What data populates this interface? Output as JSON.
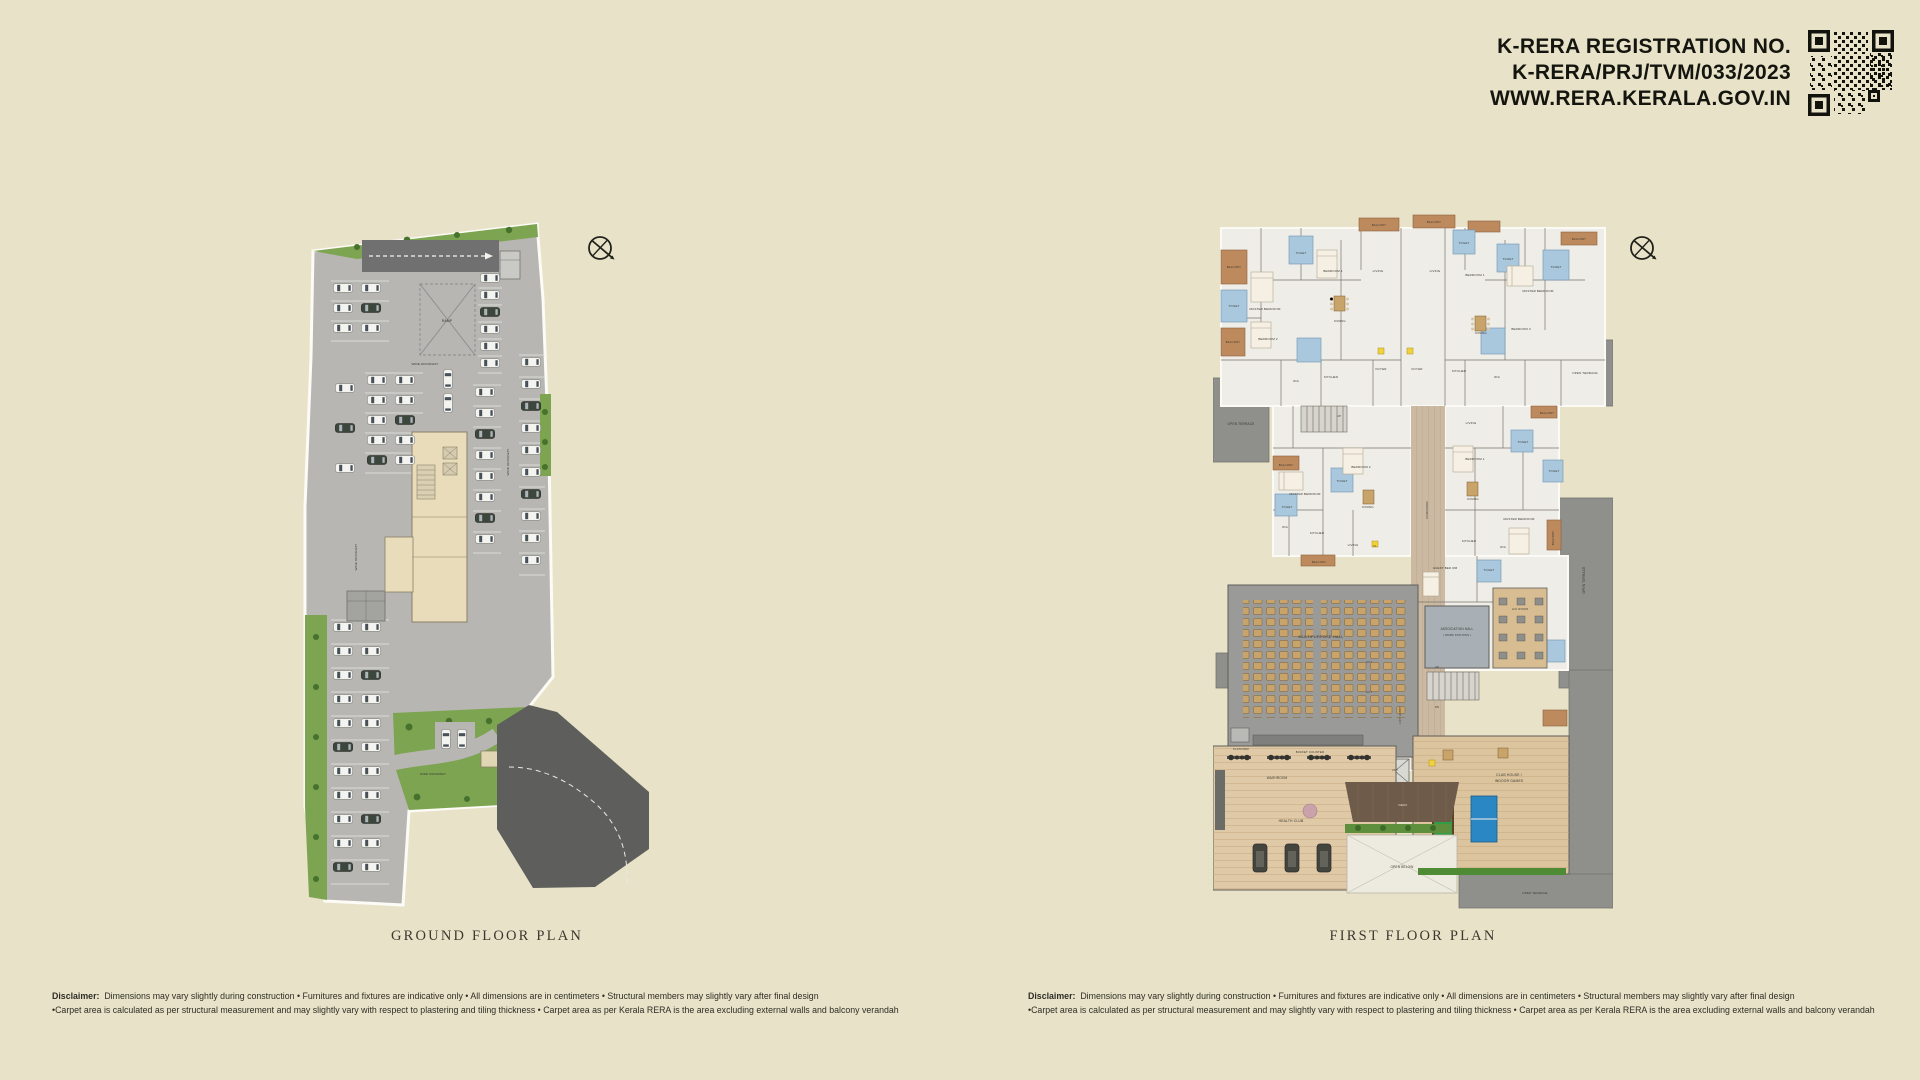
{
  "header": {
    "line1": "K-RERA REGISTRATION NO.",
    "line2": "K-RERA/PRJ/TVM/033/2023",
    "line3": "WWW.RERA.KERALA.GOV.IN"
  },
  "plans": {
    "ground": {
      "title": "GROUND FLOOR PLAN",
      "labels": [
        {
          "t": "RAMP",
          "x": 150,
          "y": 115,
          "s": 3.4
        },
        {
          "t": "WIDE DRIVEWAY",
          "x": 128,
          "y": 158,
          "s": 3.1
        },
        {
          "t": "WIDE DRIVEWAY",
          "x": 60,
          "y": 350,
          "r": -90,
          "s": 3.1
        },
        {
          "t": "WIDE DRIVEWAY",
          "x": 212,
          "y": 255,
          "r": -90,
          "s": 3.1
        },
        {
          "t": "WIDE DRIVEWAY",
          "x": 136,
          "y": 568,
          "s": 3
        }
      ]
    },
    "first": {
      "title": "FIRST FLOOR PLAN",
      "labels": [
        {
          "t": "BALCONY",
          "x": 21,
          "y": 58,
          "s": 2.8
        },
        {
          "t": "TOILET",
          "x": 21,
          "y": 97,
          "s": 2.8
        },
        {
          "t": "BALCONY",
          "x": 20,
          "y": 133,
          "s": 2.8
        },
        {
          "t": "MASTER BEDROOM",
          "x": 52,
          "y": 100,
          "s": 3
        },
        {
          "t": "BEDROOM 2",
          "x": 55,
          "y": 130,
          "s": 3
        },
        {
          "t": "TOILET",
          "x": 88,
          "y": 44,
          "s": 2.8
        },
        {
          "t": "BEDROOM 1",
          "x": 120,
          "y": 62,
          "s": 3
        },
        {
          "t": "DINING",
          "x": 127,
          "y": 112,
          "s": 3
        },
        {
          "t": "BALCONY",
          "x": 166,
          "y": 16,
          "s": 2.8
        },
        {
          "t": "LIVING",
          "x": 165,
          "y": 62,
          "s": 3
        },
        {
          "t": "BALCONY",
          "x": 221,
          "y": 13,
          "s": 2.8
        },
        {
          "t": "LIVING",
          "x": 222,
          "y": 62,
          "s": 3
        },
        {
          "t": "TOILET",
          "x": 251,
          "y": 34,
          "s": 2.8
        },
        {
          "t": "BEDROOM 1",
          "x": 262,
          "y": 66,
          "s": 3
        },
        {
          "t": "TOILET",
          "x": 295,
          "y": 50,
          "s": 2.8
        },
        {
          "t": "MASTER BEDROOM",
          "x": 325,
          "y": 82,
          "s": 3
        },
        {
          "t": "TOILET",
          "x": 343,
          "y": 58,
          "s": 2.8
        },
        {
          "t": "BALCONY",
          "x": 366,
          "y": 30,
          "s": 2.8
        },
        {
          "t": "DINING",
          "x": 268,
          "y": 124,
          "s": 3
        },
        {
          "t": "BEDROOM 3",
          "x": 308,
          "y": 120,
          "s": 3
        },
        {
          "t": "OPEN TERRACE",
          "x": 28,
          "y": 215,
          "s": 3.2
        },
        {
          "t": "W/A",
          "x": 83,
          "y": 172,
          "s": 2.8
        },
        {
          "t": "KITCHEN",
          "x": 118,
          "y": 168,
          "s": 3
        },
        {
          "t": "FOYER",
          "x": 168,
          "y": 160,
          "s": 3
        },
        {
          "t": "FOYER",
          "x": 204,
          "y": 160,
          "s": 3
        },
        {
          "t": "KITCHEN",
          "x": 246,
          "y": 162,
          "s": 3
        },
        {
          "t": "W/A",
          "x": 284,
          "y": 168,
          "s": 2.8
        },
        {
          "t": "OPEN TERRACE",
          "x": 372,
          "y": 164,
          "s": 3
        },
        {
          "t": "UP",
          "x": 126,
          "y": 207,
          "s": 2.8
        },
        {
          "t": "BALCONY",
          "x": 73,
          "y": 256,
          "s": 2.8
        },
        {
          "t": "BEDROOM 2",
          "x": 148,
          "y": 258,
          "s": 3
        },
        {
          "t": "MASTER BEDROOM",
          "x": 92,
          "y": 285,
          "s": 3
        },
        {
          "t": "TOILET",
          "x": 129,
          "y": 272,
          "s": 2.8
        },
        {
          "t": "TOILET",
          "x": 74,
          "y": 298,
          "s": 2.8
        },
        {
          "t": "DINING",
          "x": 155,
          "y": 298,
          "s": 3
        },
        {
          "t": "W/A",
          "x": 72,
          "y": 318,
          "s": 2.8
        },
        {
          "t": "KITCHEN",
          "x": 104,
          "y": 324,
          "s": 3
        },
        {
          "t": "LIVING",
          "x": 140,
          "y": 336,
          "s": 3
        },
        {
          "t": "BALCONY",
          "x": 106,
          "y": 353,
          "s": 2.8
        },
        {
          "t": "LIVING",
          "x": 258,
          "y": 214,
          "s": 3
        },
        {
          "t": "BALCONY",
          "x": 334,
          "y": 204,
          "s": 2.8
        },
        {
          "t": "TOILET",
          "x": 310,
          "y": 233,
          "s": 2.8
        },
        {
          "t": "BEDROOM 1",
          "x": 262,
          "y": 250,
          "s": 3
        },
        {
          "t": "DINING",
          "x": 260,
          "y": 290,
          "s": 3
        },
        {
          "t": "MASTER BEDROOM",
          "x": 306,
          "y": 310,
          "s": 3
        },
        {
          "t": "TOILET",
          "x": 341,
          "y": 262,
          "s": 2.8
        },
        {
          "t": "BALCONY",
          "x": 341,
          "y": 328,
          "r": -90,
          "s": 2.8
        },
        {
          "t": "KITCHEN",
          "x": 256,
          "y": 332,
          "s": 3
        },
        {
          "t": "W/A",
          "x": 290,
          "y": 338,
          "s": 2.8
        },
        {
          "t": "CORRIDOR",
          "x": 215,
          "y": 300,
          "r": -90,
          "s": 3
        },
        {
          "t": "GUEST BED RM",
          "x": 232,
          "y": 359,
          "s": 3
        },
        {
          "t": "TOILET",
          "x": 276,
          "y": 361,
          "s": 2.8
        },
        {
          "t": "K1",
          "x": 162,
          "y": 337,
          "s": 2.6,
          "c": "#4a3d0a"
        },
        {
          "t": "ASSOCIATION HALL",
          "x": 244,
          "y": 420,
          "s": 3.2
        },
        {
          "t": "( WORK STATIONS )",
          "x": 244,
          "y": 426,
          "s": 2.7
        },
        {
          "t": "A/C ROOM",
          "x": 307,
          "y": 400,
          "s": 3
        },
        {
          "t": "OPEN TERRACE",
          "x": 372,
          "y": 370,
          "r": -90,
          "s": 3.2
        },
        {
          "t": "LIFT",
          "x": 156,
          "y": 453,
          "s": 2.8
        },
        {
          "t": "LIFT",
          "x": 156,
          "y": 483,
          "s": 2.8
        },
        {
          "t": "LIFT LOBBY",
          "x": 188,
          "y": 505,
          "r": -90,
          "s": 2.8
        },
        {
          "t": "UP",
          "x": 224,
          "y": 458,
          "s": 2.6
        },
        {
          "t": "DN",
          "x": 224,
          "y": 498,
          "s": 2.6
        },
        {
          "t": "MULTIPURPOSE HALL",
          "x": 108,
          "y": 428,
          "s": 4
        },
        {
          "t": "PLATFORM",
          "x": 28,
          "y": 540,
          "s": 2.7
        },
        {
          "t": "BUFFET COUNTER",
          "x": 97,
          "y": 543,
          "s": 2.9
        },
        {
          "t": "WASHROOM",
          "x": 64,
          "y": 569,
          "s": 3.2
        },
        {
          "t": "LIFT",
          "x": 182,
          "y": 561,
          "s": 2.6
        },
        {
          "t": "CLUB HOUSE /",
          "x": 296,
          "y": 566,
          "s": 3.4
        },
        {
          "t": "INDOOR GAMES",
          "x": 296,
          "y": 572,
          "s": 3.4
        },
        {
          "t": "HEALTH CLUB",
          "x": 78,
          "y": 612,
          "s": 3.4
        },
        {
          "t": "DECK",
          "x": 190,
          "y": 596,
          "s": 3,
          "c": "#f2ead8"
        },
        {
          "t": "OPEN BELOW",
          "x": 189,
          "y": 658,
          "s": 3.2
        },
        {
          "t": "OPEN TERRACE",
          "x": 322,
          "y": 684,
          "s": 3
        }
      ]
    }
  },
  "disclaimer": {
    "label": "Disclaimer:",
    "line1": "Dimensions may vary slightly during construction  • Furnitures and fixtures are indicative only  • All dimensions are in centimeters  • Structural members may slightly vary after final design",
    "line2": "•Carpet area is calculated as per structural measurement and may slightly vary with respect to plastering and tiling thickness  • Carpet area as per Kerala RERA is the area excluding external walls and balcony verandah"
  },
  "colors": {
    "background": "#e8e3c8",
    "ink": "#15150f",
    "title_text": "#3c382f",
    "parking_gray": "#b7b6b2",
    "road_dark": "#5e5e5c",
    "ramp_gray": "#707070",
    "landscape_green": "#7da450",
    "bush_green": "#46722e",
    "core_beige": "#e8dcba",
    "floor_white": "#efede8",
    "terrace_gray": "#8f8f8c",
    "toilet_blue": "#a9c8de",
    "balcony_terracotta": "#bd8a5e",
    "corridor_tan": "#cbb9a2",
    "hall_gray": "#9a9a98",
    "chair_tan": "#c8a36a",
    "wood_floor": "#dcc49e",
    "billiards_green": "#2f9e44",
    "table_tennis_blue": "#2b86c4",
    "deck_brown": "#6e5b49",
    "hedge_green": "#4f8a35",
    "tag_yellow": "#f2d23c"
  }
}
